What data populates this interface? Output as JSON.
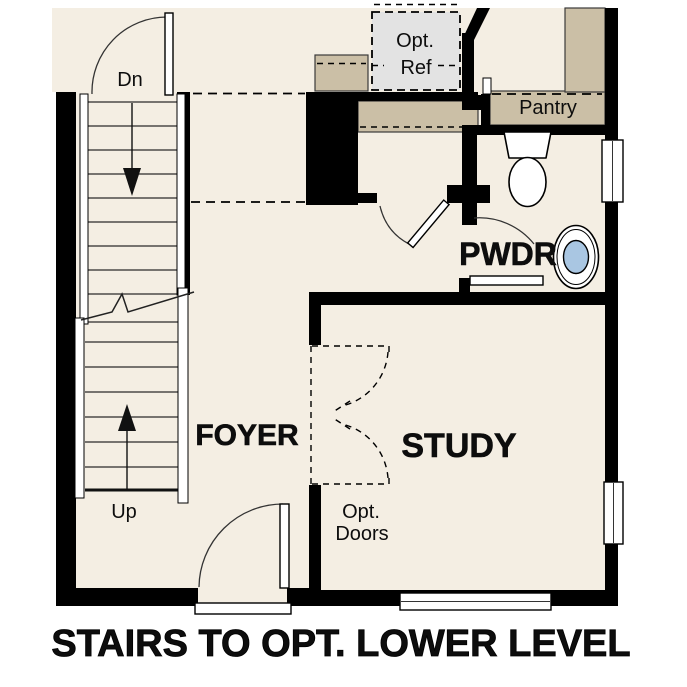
{
  "floorplan": {
    "caption": "STAIRS TO OPT. LOWER LEVEL",
    "labels": {
      "stairs_down": "Dn",
      "stairs_up": "Up",
      "foyer": "FOYER",
      "study": "STUDY",
      "powder": "PWDR",
      "pantry": "Pantry",
      "opt_ref": [
        "Opt.",
        "Ref"
      ],
      "opt_doors": [
        "Opt.",
        "Doors"
      ]
    },
    "colors": {
      "floor": "#F4EEE3",
      "wall": "#000000",
      "counter": "#CBBFA6",
      "appliance": "#E3E3E3",
      "sink": "#A9C6E2",
      "paper": "#FFFFFF"
    }
  }
}
